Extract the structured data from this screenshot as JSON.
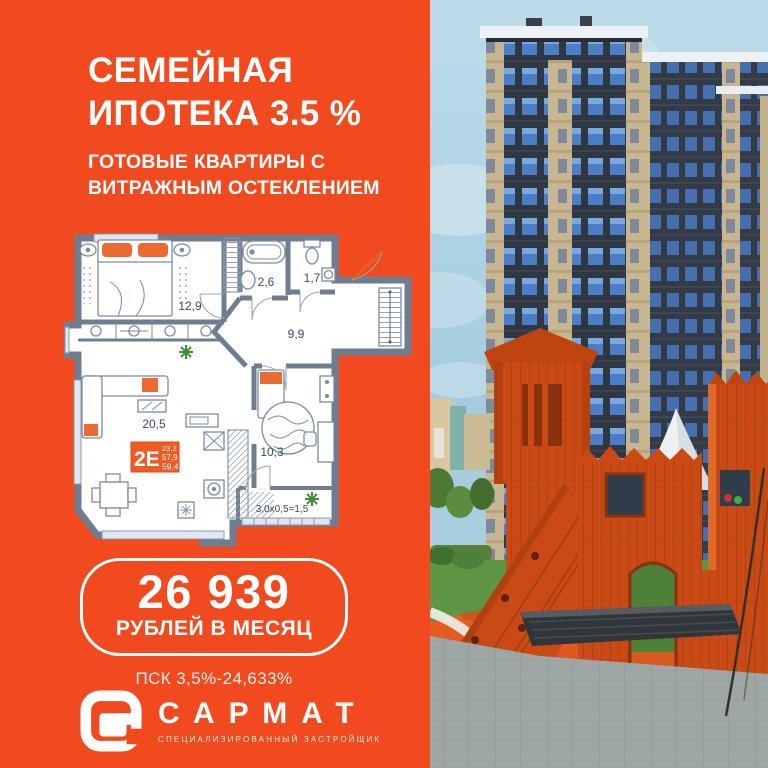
{
  "header": {
    "headline_line1": "СЕМЕЙНАЯ",
    "headline_line2": "ИПОТЕКА 3.5 %",
    "subheadline_line1": "ГОТОВЫЕ КВАРТИРЫ С",
    "subheadline_line2": "ВИТРАЖНЫМ ОСТЕКЛЕНИЕМ"
  },
  "floorplan": {
    "unit_code": "2Е",
    "areas": {
      "living": "23,2",
      "apartment": "57,9",
      "total": "59,4"
    },
    "rooms": {
      "bedroom": "12,9",
      "bathroom": "2,6",
      "wc": "1,7",
      "hall": "9,9",
      "kitchen_living": "20,5",
      "bedroom2": "10,3",
      "balcony": "3,0x0,5=1,5"
    }
  },
  "offer": {
    "monthly_payment": "26 939",
    "payment_caption": "РУБЛЕЙ В МЕСЯЦ",
    "psk": "ПСК 3,5%-24,633%"
  },
  "brand": {
    "name": "САРМАТ",
    "tagline": "СПЕЦИАЛИЗИРОВАННЫЙ ЗАСТРОЙЩИК"
  },
  "colors": {
    "background": "#f14a1e",
    "unit_box": "#ef5b25",
    "plan_wall": "#6e7d90",
    "sky": "#aed2e3",
    "playground_wood": "#c94a15",
    "pavement": "#9ea7a5"
  }
}
